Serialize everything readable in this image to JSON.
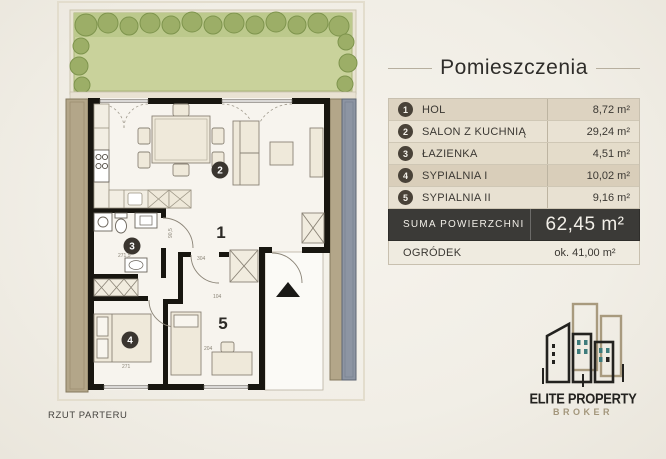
{
  "panel": {
    "title": "Pomieszczenia",
    "rooms": [
      {
        "num": "1",
        "label": "HOL",
        "area": "8,72 m²"
      },
      {
        "num": "2",
        "label": "SALON Z KUCHNIĄ",
        "area": "29,24 m²"
      },
      {
        "num": "3",
        "label": "ŁAZIENKA",
        "area": "4,51 m²"
      },
      {
        "num": "4",
        "label": "SYPIALNIA I",
        "area": "10,02 m²"
      },
      {
        "num": "5",
        "label": "SYPIALNIA II",
        "area": "9,16 m²"
      }
    ],
    "summary": {
      "label": "SUMA POWIERZCHNI",
      "value": "62,45 m²"
    },
    "garden": {
      "label": "OGRÓDEK",
      "value": "ok. 41,00 m²"
    }
  },
  "plan": {
    "caption": "RZUT PARTERU",
    "numbers": {
      "n1": "1",
      "n2": "2",
      "n3": "3",
      "n4": "4",
      "n5": "5"
    },
    "dims": {
      "d304": "304",
      "d104": "104",
      "d2715": "271,5",
      "d271": "271",
      "d204": "204",
      "d905": "90,5"
    }
  },
  "logo": {
    "line1": "ELITE PROPERTY",
    "line2": "BROKER"
  },
  "colors": {
    "wall": "#181610",
    "grass": "#c9d29b",
    "bush": "#9cae67",
    "tan_strip": "#b3a689",
    "steel_strip": "#8d95a3",
    "badge": "#494238",
    "dark_row": "#3b3a37"
  }
}
